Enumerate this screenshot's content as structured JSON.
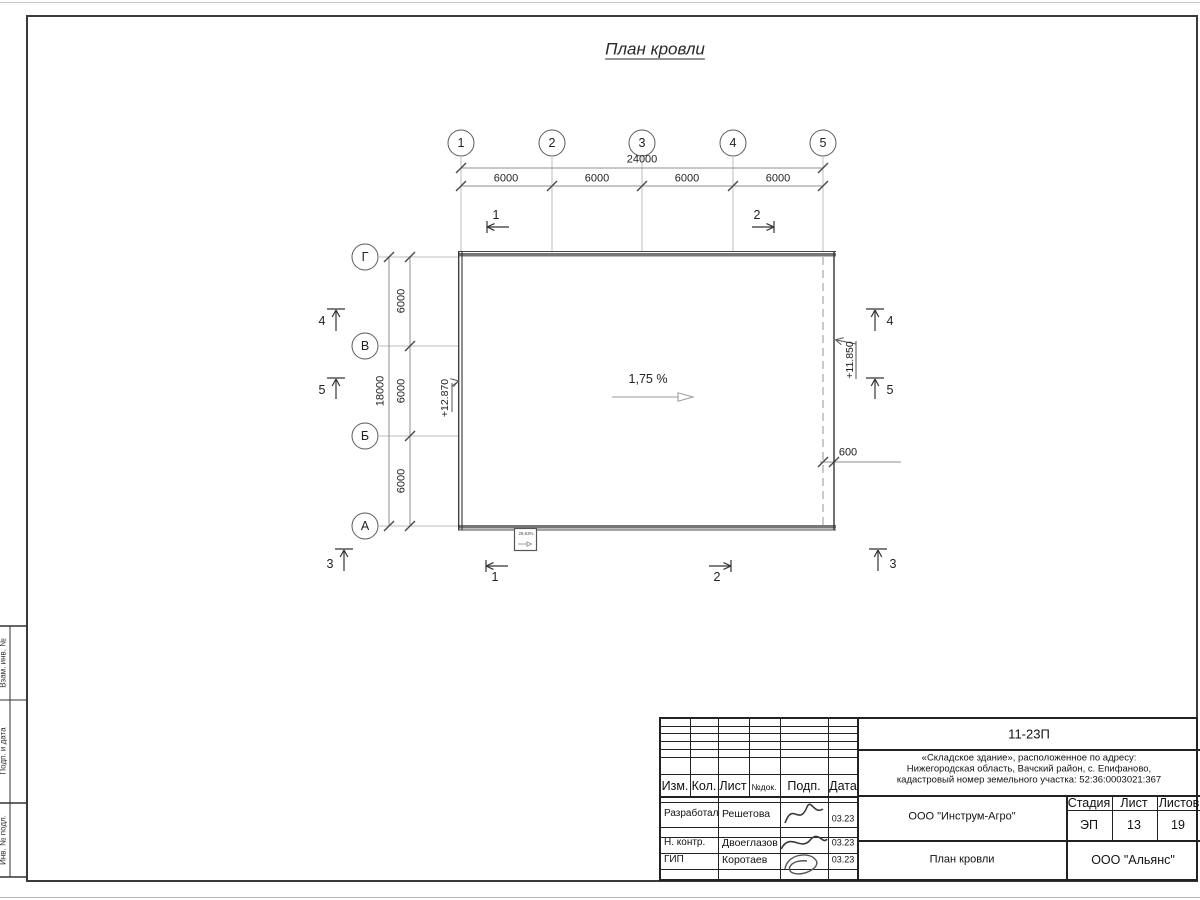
{
  "page": {
    "title": "План кровли"
  },
  "axes": {
    "columns": [
      "1",
      "2",
      "3",
      "4",
      "5"
    ],
    "rows": [
      "Г",
      "В",
      "Б",
      "А"
    ]
  },
  "dims": {
    "top_total": "24000",
    "top_segments": [
      "6000",
      "6000",
      "6000",
      "6000"
    ],
    "left_total": "18000",
    "left_segments": [
      "6000",
      "6000",
      "6000"
    ],
    "overhang": "600"
  },
  "annot": {
    "slope": "1,75 %",
    "elev_left": "+12.870",
    "elev_right": "+11.850",
    "drain": "29,63%"
  },
  "sections": {
    "s1": "1",
    "s2": "2",
    "s3": "3",
    "s4": "4",
    "s5": "5"
  },
  "margin_stamp": {
    "labels": [
      "Взам. инв. №",
      "Подп. и дата",
      "Инв. № подл."
    ]
  },
  "title_block": {
    "doc_number": "11-23П",
    "object_line1": "«Складское здание», расположенное по адресу:",
    "object_line2": "Нижегородская область, Вачский район, с. Епифаново,",
    "object_line3": "кадастровый номер земельного участка: 52:36:0003021:367",
    "headers": {
      "izm": "Изм.",
      "kol": "Кол.",
      "list": "Лист",
      "ndoc": "№док.",
      "podp": "Подп.",
      "data": "Дата"
    },
    "rows": [
      {
        "role": "Разработал",
        "name": "Решетова",
        "date": "03.23"
      },
      {
        "role": "Н. контр.",
        "name": "Двоеглазов",
        "date": "03.23"
      },
      {
        "role": "ГИП",
        "name": "Коротаев",
        "date": "03.23"
      }
    ],
    "stage_label": "Стадия",
    "sheet_label": "Лист",
    "sheets_label": "Листов",
    "stage": "ЭП",
    "sheet": "13",
    "sheets": "19",
    "org": "ООО \"Инструм-Агро\"",
    "drawing_title": "План кровли",
    "firm": "ООО \"Альянс\""
  },
  "style": {
    "line_dark": "#333333",
    "line_gray": "#8f8f8f",
    "roof_edge": "#767676"
  }
}
